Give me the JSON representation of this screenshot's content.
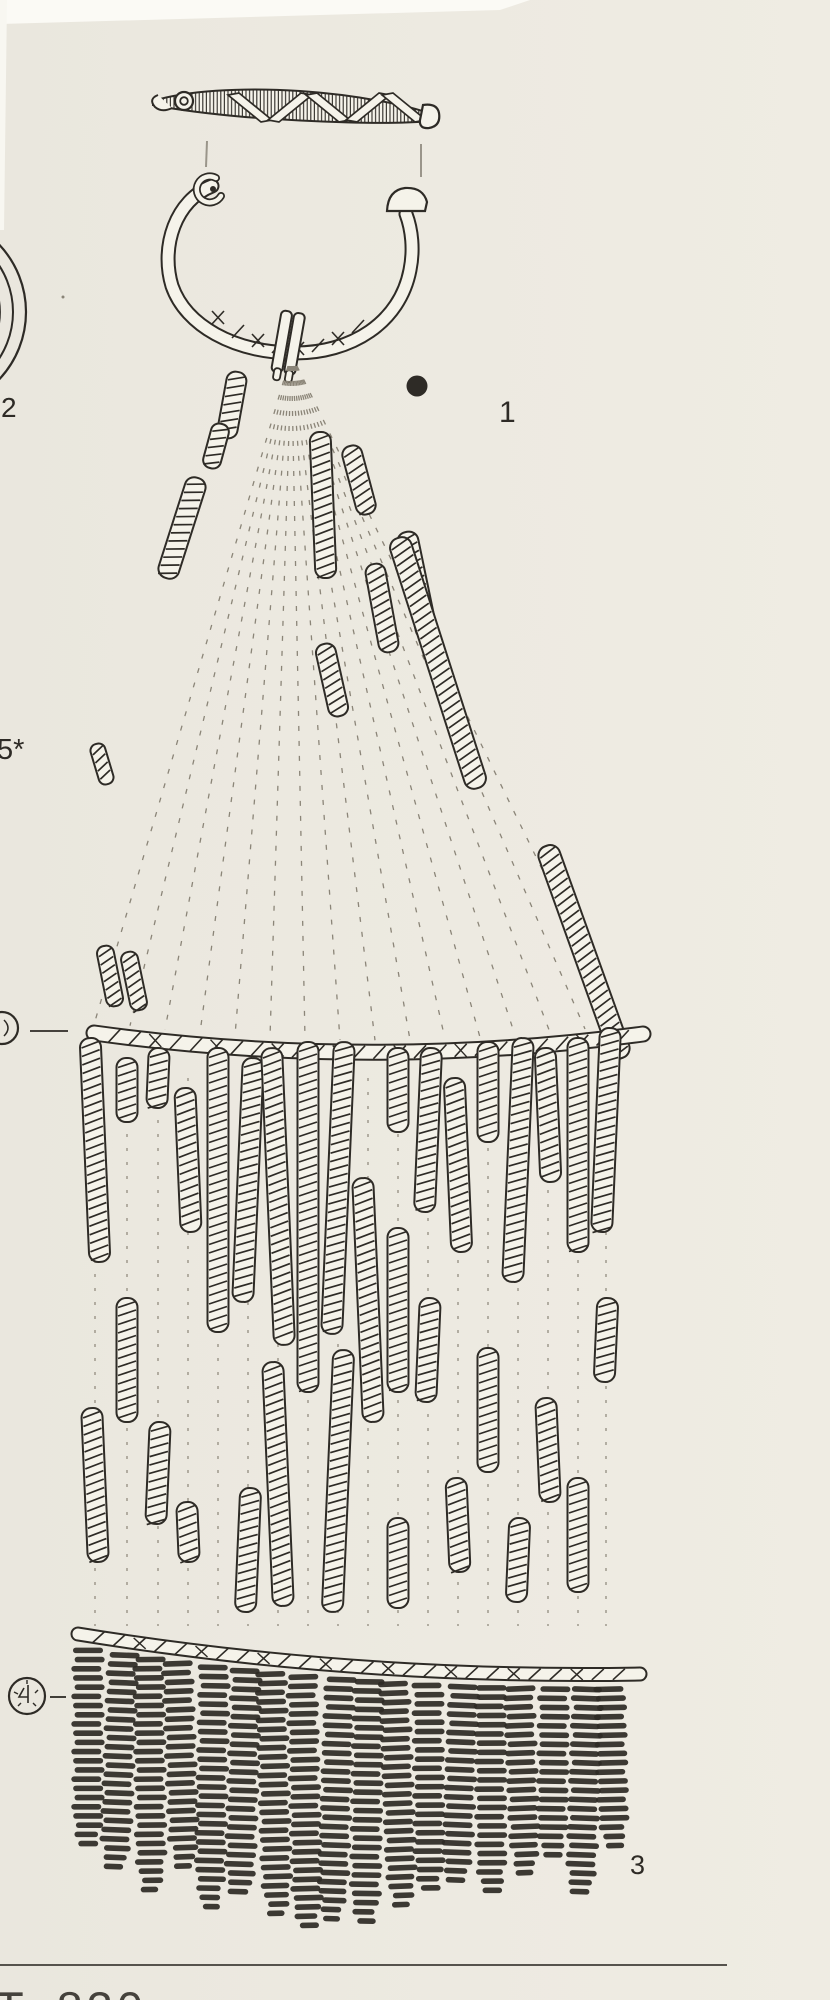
{
  "plate": {
    "caption_partial": "T. 830",
    "labels": {
      "fibula": "1",
      "spiral_disc_fragment": "2",
      "pendant_fringe": "3",
      "plate_number": "5*"
    },
    "colors": {
      "paper": "#edeae1",
      "ink": "#2e2b26",
      "faint_line": "#8b8578"
    }
  }
}
